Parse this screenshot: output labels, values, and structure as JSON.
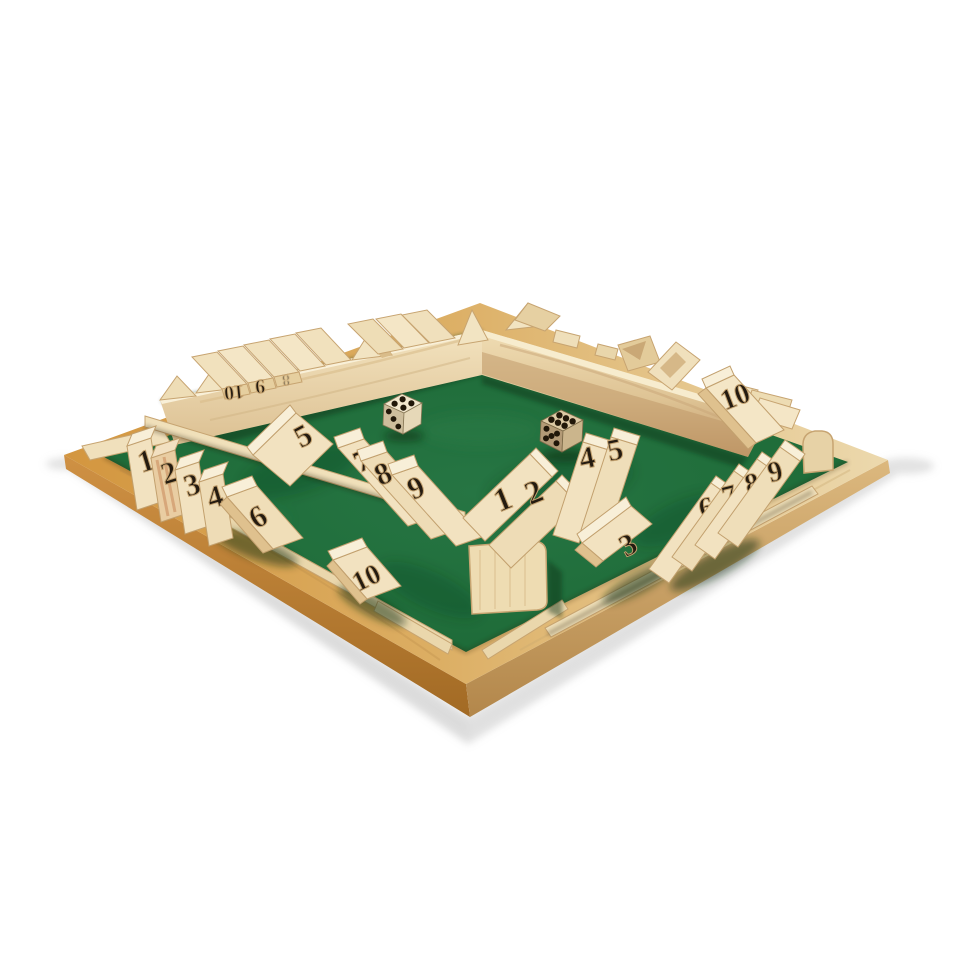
{
  "scene": {
    "type": "product-photo",
    "subject": "Four-player wooden Shut The Box dice board game with green felt and two dice",
    "background_color": "#ffffff"
  },
  "palette": {
    "felt_green": "#1e6b38",
    "felt_dark": "#114a26",
    "rim_amber": "#d3963f",
    "rim_pale": "#ecd9ae",
    "rim_side_dark": "#a8701f",
    "pine_light": "#f2e2c0",
    "pine_mid": "#e9d3a6",
    "pine_end_grain": "#dfc18e",
    "pine_shadow": "#c7a471",
    "red_grain": "#c8895a",
    "ink": "#241b10",
    "die_light": "#f1e6cc",
    "die_dark": "#dcc9a4",
    "shadow_gray": "#b9b9b9"
  },
  "tiles": {
    "front_left": {
      "n1": "1",
      "n2": "2",
      "n3": "3",
      "n4": "4",
      "n5": "5",
      "n6": "6",
      "n7": "7",
      "n8": "8",
      "n9": "9",
      "n10": "10"
    },
    "front_right": {
      "n1": "1",
      "n2": "2",
      "n3": "3",
      "n4": "4",
      "n5": "5",
      "n6": "6",
      "n7": "7",
      "n8": "8",
      "n9": "9",
      "n10": "10"
    },
    "back_left": {
      "n10": "10",
      "n9": "9",
      "n8": "8",
      "n7": "7"
    },
    "back_right": {
      "n10": "10"
    }
  },
  "dice": {
    "light": {
      "top": 4,
      "front": 3
    },
    "dark": {
      "top": 6,
      "front": 5
    }
  }
}
